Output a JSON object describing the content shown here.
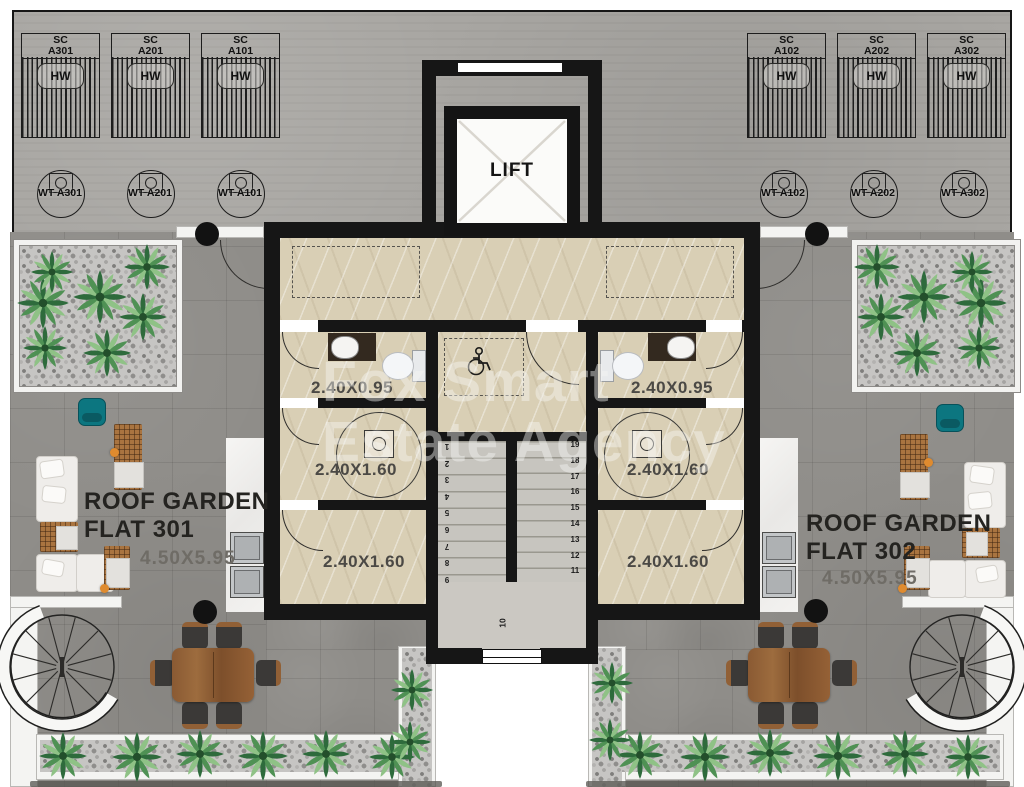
{
  "plan": {
    "watermark": {
      "line1": "Fox Smart",
      "line2": "Estate Agency"
    },
    "lift": {
      "label": "LIFT"
    },
    "panels": {
      "left": [
        {
          "type": "SC",
          "id": "A301",
          "hw": "HW"
        },
        {
          "type": "SC",
          "id": "A201",
          "hw": "HW"
        },
        {
          "type": "SC",
          "id": "A101",
          "hw": "HW"
        }
      ],
      "right": [
        {
          "type": "SC",
          "id": "A102",
          "hw": "HW"
        },
        {
          "type": "SC",
          "id": "A202",
          "hw": "HW"
        },
        {
          "type": "SC",
          "id": "A302",
          "hw": "HW"
        }
      ]
    },
    "tanks": {
      "left": [
        "WT A301",
        "WT A201",
        "WT A101"
      ],
      "right": [
        "WT A102",
        "WT A202",
        "WT A302"
      ]
    },
    "rooms": {
      "left": {
        "bath": "2.40X0.95",
        "shower": "2.40X1.60",
        "store": "2.40X1.60"
      },
      "right": {
        "bath": "2.40X0.95",
        "shower": "2.40X1.60",
        "store": "2.40X1.60"
      }
    },
    "flats": {
      "left": {
        "title": "ROOF GARDEN",
        "flat": "FLAT 301",
        "dims": "4.50X5.95"
      },
      "right": {
        "title": "ROOF GARDEN",
        "flat": "FLAT 302",
        "dims": "4.50X5.95"
      }
    },
    "stairs": {
      "up": [
        "1",
        "2",
        "3",
        "4",
        "5",
        "6",
        "7",
        "8",
        "9"
      ],
      "mid": "10",
      "down": [
        "19",
        "18",
        "17",
        "16",
        "15",
        "14",
        "13",
        "12",
        "11"
      ]
    },
    "colors": {
      "wall": "#161616",
      "floor_beige": "#d9cfb5",
      "terrace": "#8f8d89",
      "teal": "#0c7680",
      "wood": "#9a6a3d"
    }
  }
}
